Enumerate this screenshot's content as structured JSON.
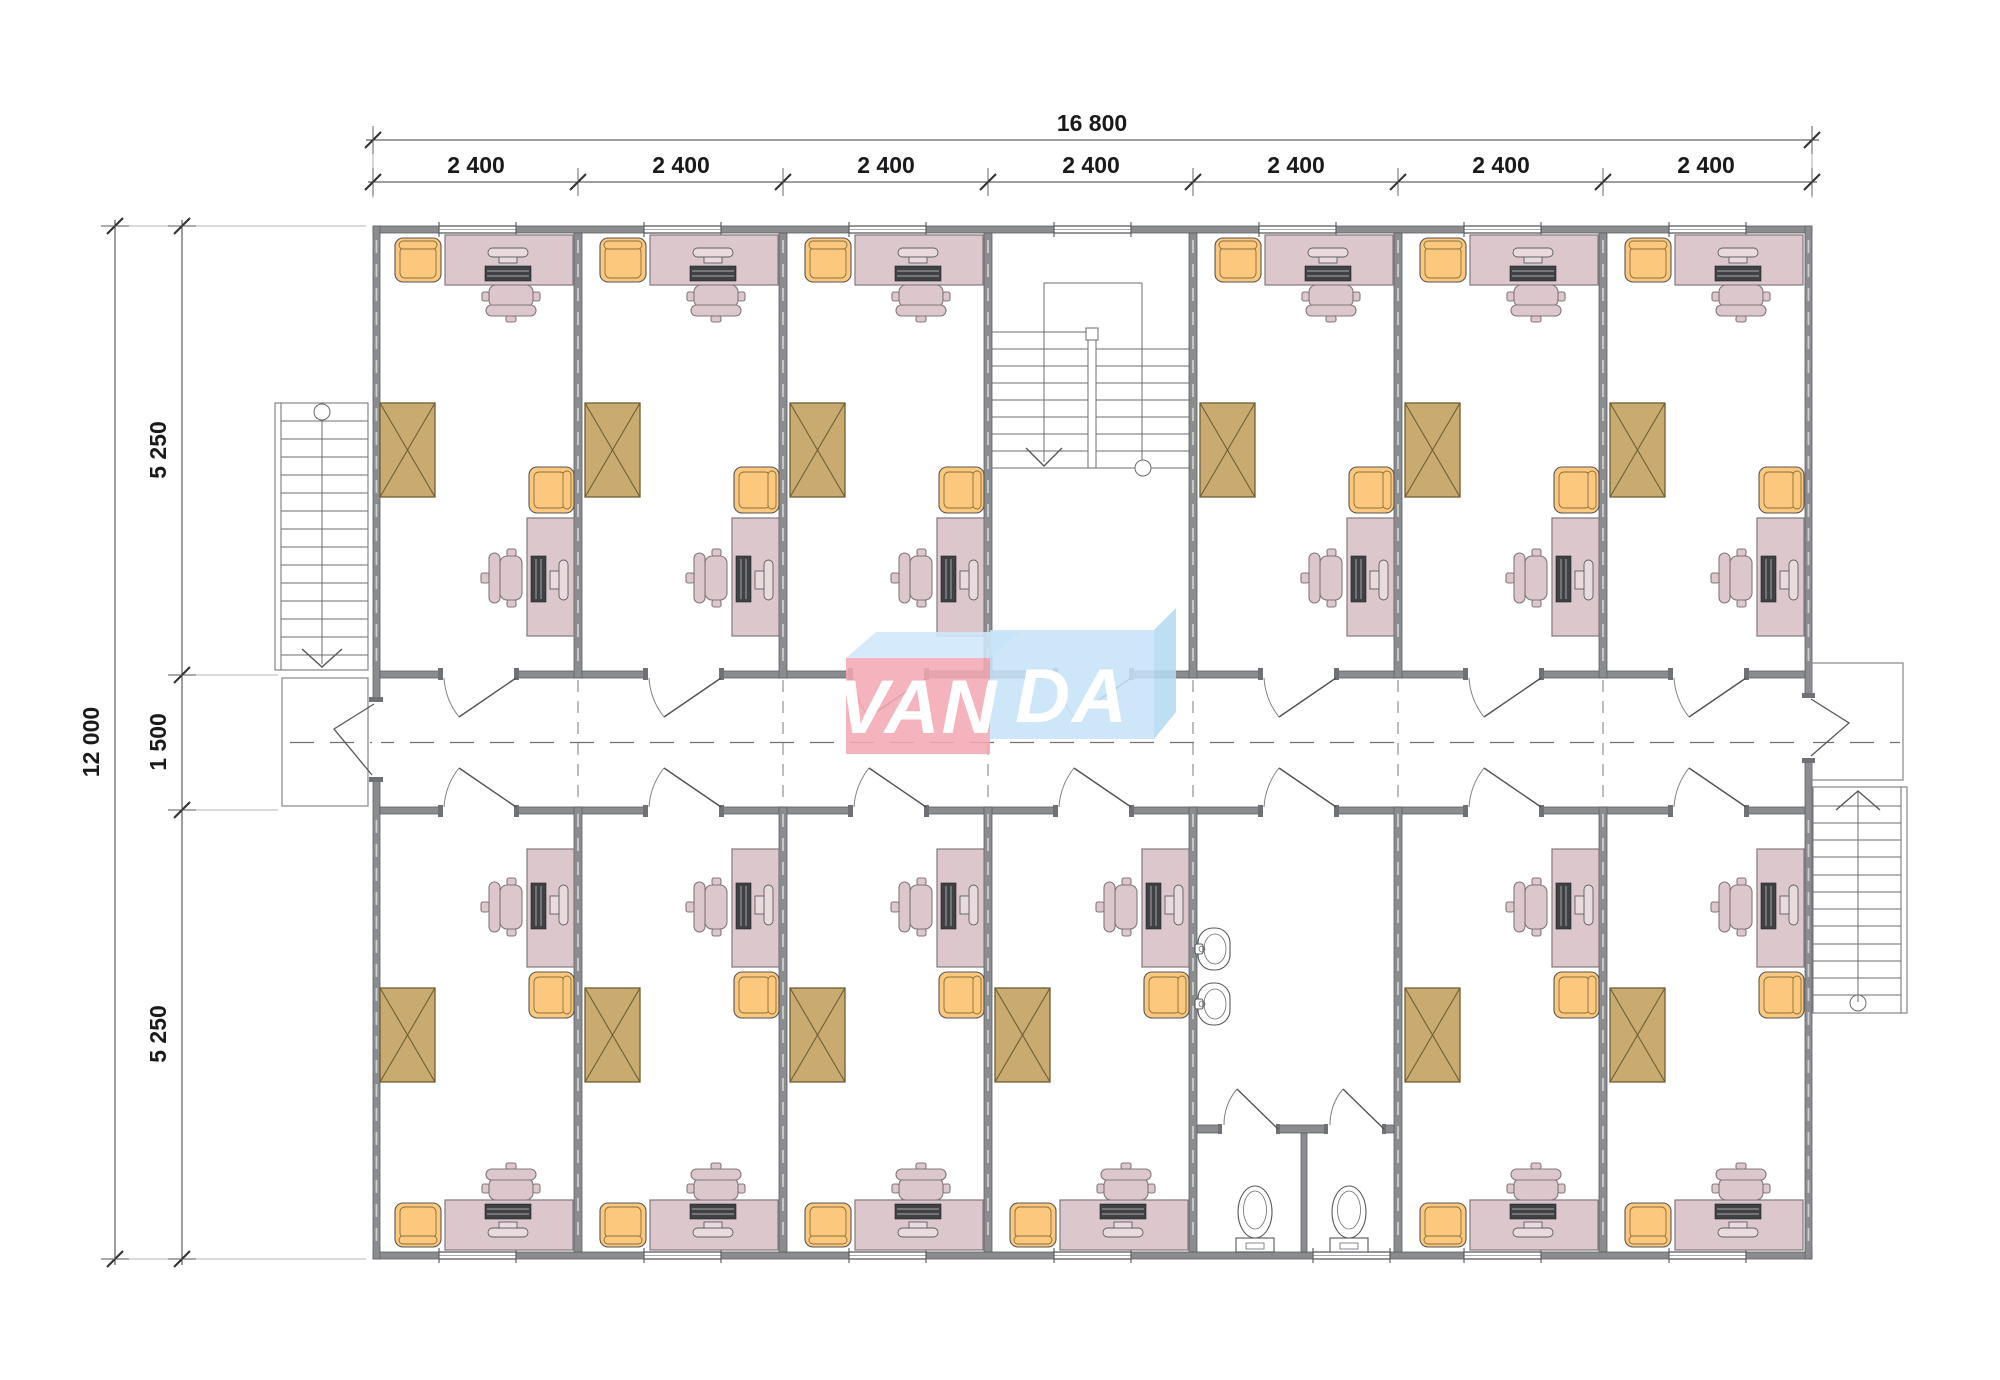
{
  "dimensions": {
    "top_total": "16 800",
    "top_bays": [
      "2 400",
      "2 400",
      "2 400",
      "2 400",
      "2 400",
      "2 400",
      "2 400"
    ],
    "left_total": "12 000",
    "left_segments": [
      "5 250",
      "1 500",
      "5 250"
    ]
  },
  "logo": {
    "text": "VANDA",
    "left": "VAN",
    "right": "DA",
    "panel_left_color": "#f2a9b4",
    "panel_right_color": "#c6e3f7",
    "top_face_color": "#cfe8fa",
    "side_face_color": "#b5d9f2",
    "text_color": "#ffffff"
  },
  "palette": {
    "wall": "#8a8c8f",
    "desk": "#dcc7cc",
    "armchair": "#fbc87d",
    "wardrobe": "#c9aa70",
    "background": "#ffffff",
    "dim_text": "#1a1a1c"
  }
}
